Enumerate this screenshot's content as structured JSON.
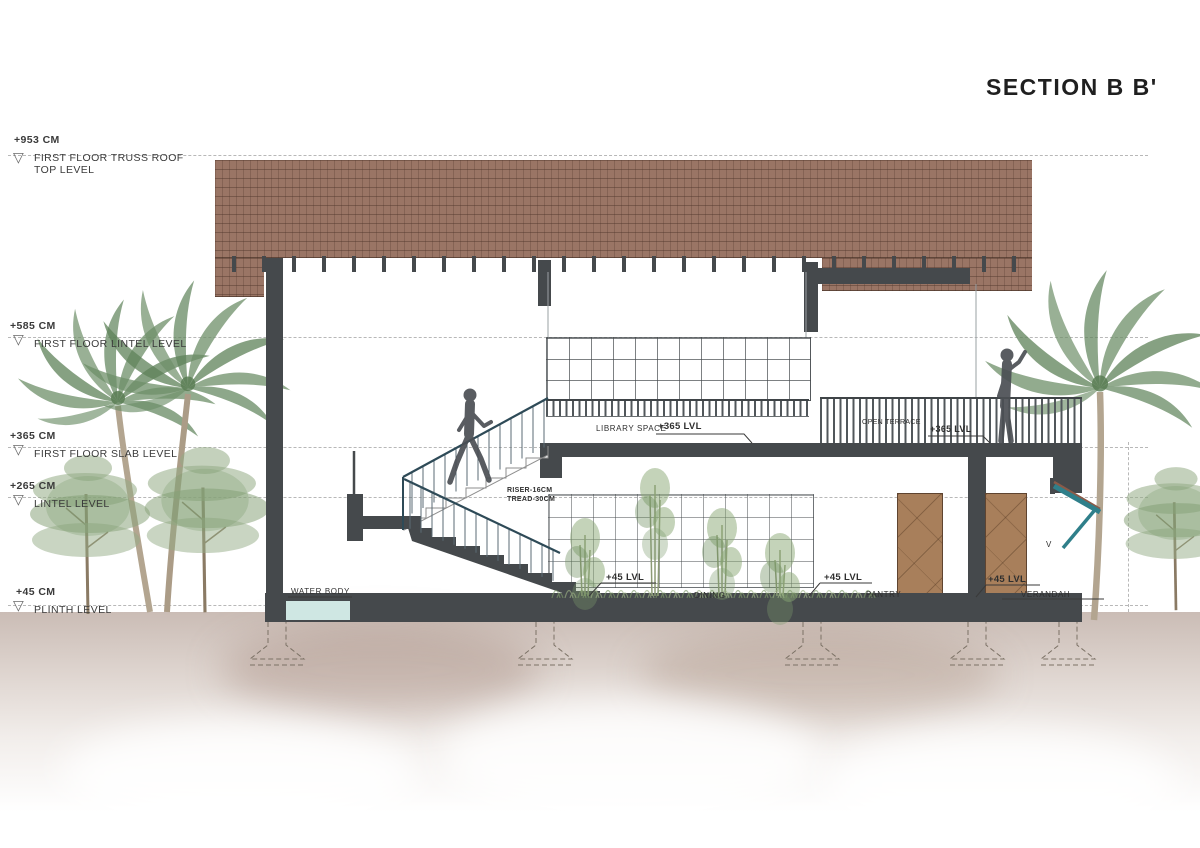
{
  "title": "SECTION B B'",
  "levels": [
    {
      "elevation": "+953 CM",
      "label": "FIRST FLOOR TRUSS ROOF TOP LEVEL"
    },
    {
      "elevation": "+585 CM",
      "label": "FIRST FLOOR LINTEL LEVEL"
    },
    {
      "elevation": "+365 CM",
      "label": "FIRST FLOOR SLAB LEVEL"
    },
    {
      "elevation": "+265 CM",
      "label": "LINTEL LEVEL"
    },
    {
      "elevation": "+45 CM",
      "label": "PLINTH LEVEL"
    }
  ],
  "labels": {
    "library_space": "LIBRARY SPACE",
    "library_lvl": "+365 LVL",
    "open_terrace": "OPEN TERRACE",
    "terrace_lvl": "+365 LVL",
    "riser": "RISER-16CM",
    "tread": "TREAD-30CM",
    "water_body": "WATER BODY",
    "dining_lvl": "+45 LVL",
    "dining": "DINING",
    "pantry_lvl": "+45 LVL",
    "pantry": "PANTRY",
    "verandah_lvl": "+45 LVL",
    "verandah": "VERANDAH",
    "v_marker": "V"
  },
  "colors": {
    "roof_tile": "#9a7565",
    "structure": "#45494c",
    "railing": "#2e4a57",
    "canopy_teal": "#2f7f8a",
    "water": "#cfe7e3",
    "door_wood": "#a87f5b",
    "ground_wash": "#b29889",
    "foliage": "#7d9a70",
    "palm_trunk": "#b3a590",
    "dashed_line": "#b8b8b8",
    "text": "#2e2e2e"
  }
}
